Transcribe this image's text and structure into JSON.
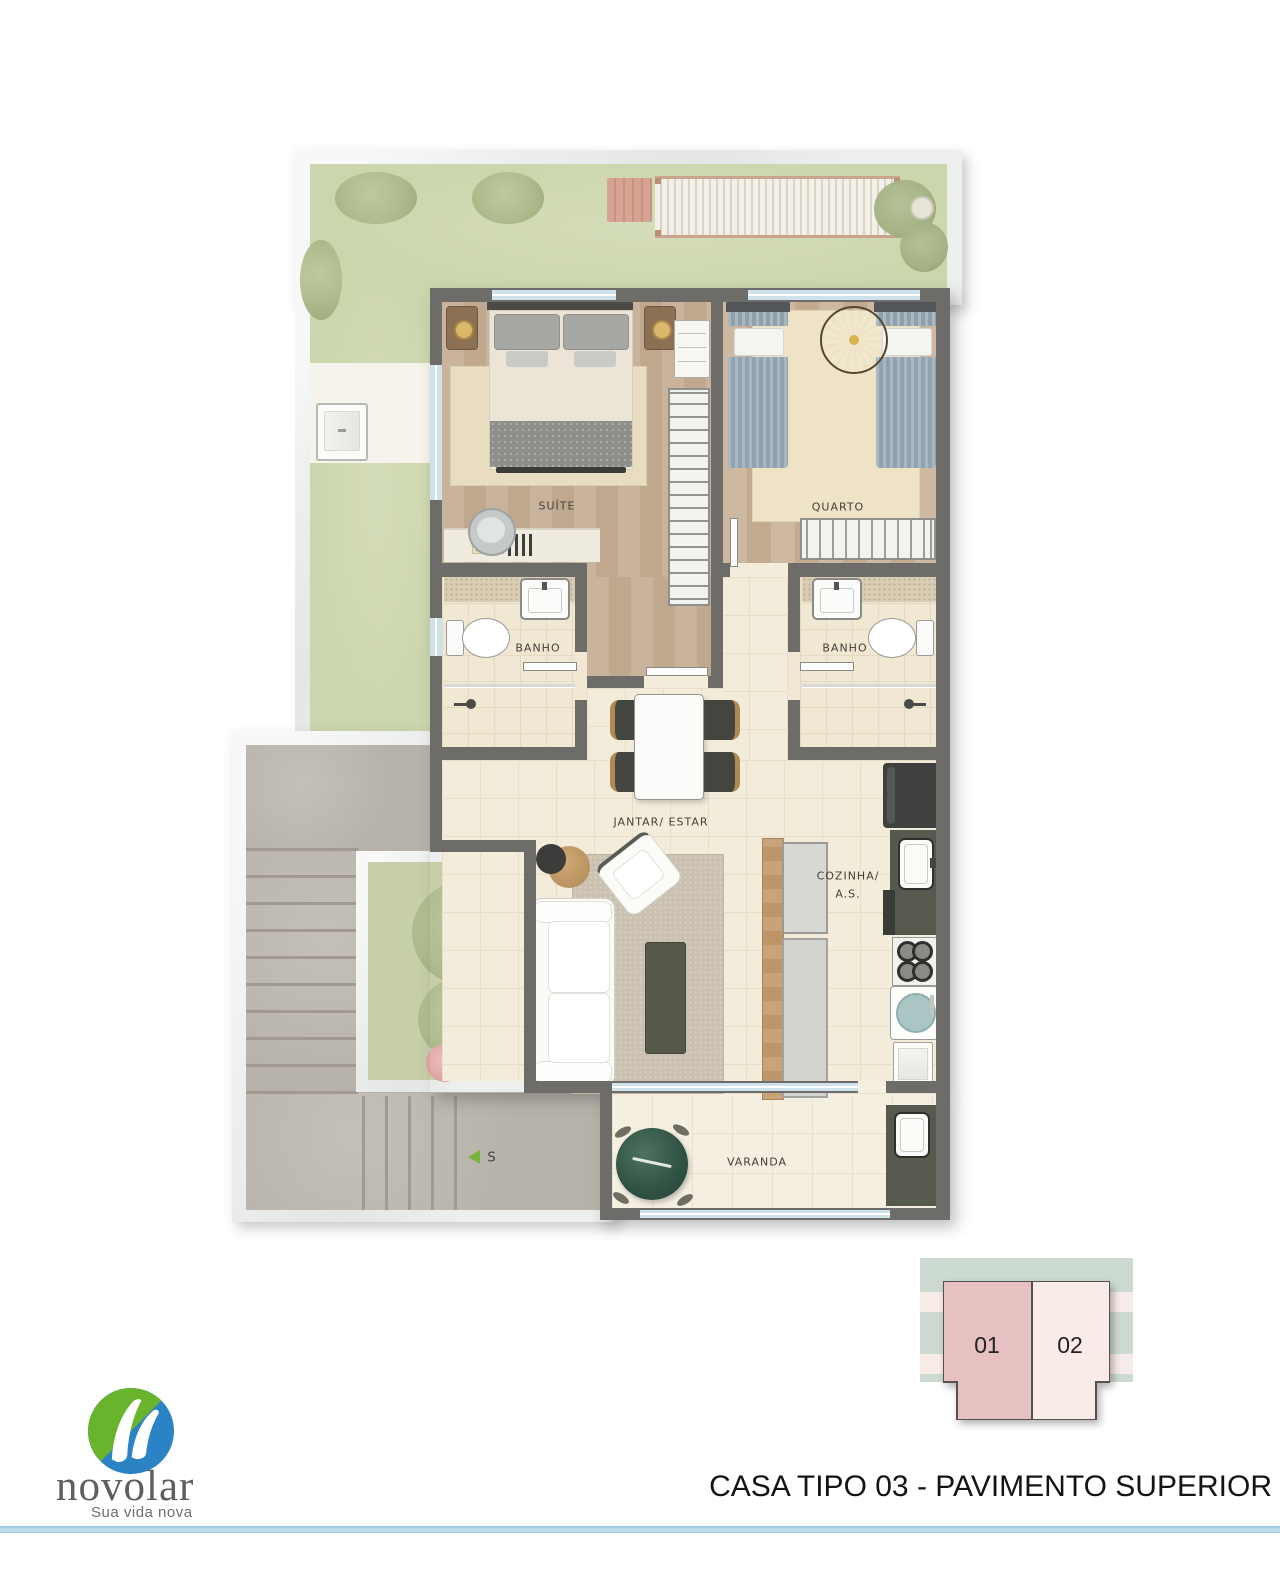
{
  "page": {
    "title": "CASA TIPO 03 - PAVIMENTO SUPERIOR"
  },
  "logo": {
    "name": "novolar",
    "tagline": "Sua vida nova",
    "mark_colors": {
      "green": "#69b32d",
      "blue": "#2b83c5"
    }
  },
  "plan": {
    "labels": {
      "suite": "SUÍTE",
      "quarto": "QUARTO",
      "banho1": "BANHO",
      "banho2": "BANHO",
      "jantar_estar": "JANTAR/ ESTAR",
      "cozinha_line1": "COZINHA/",
      "cozinha_line2": "A.S.",
      "varanda": "VARANDA",
      "stairs": "S"
    }
  },
  "key_plan": {
    "units": [
      {
        "label": "01",
        "highlighted": true,
        "color": "#e7c1c1"
      },
      {
        "label": "02",
        "highlighted": false,
        "color": "#f9ebe7"
      }
    ]
  },
  "colors": {
    "accent_line": "#aed6e8",
    "lawn": "#ccd6ac",
    "wall": "#6e6c68",
    "wood_floor": "#c6af97",
    "tile_floor": "#f3ecdb",
    "concrete": "#b7b2a9",
    "window_glass": "#cfe2ec"
  }
}
